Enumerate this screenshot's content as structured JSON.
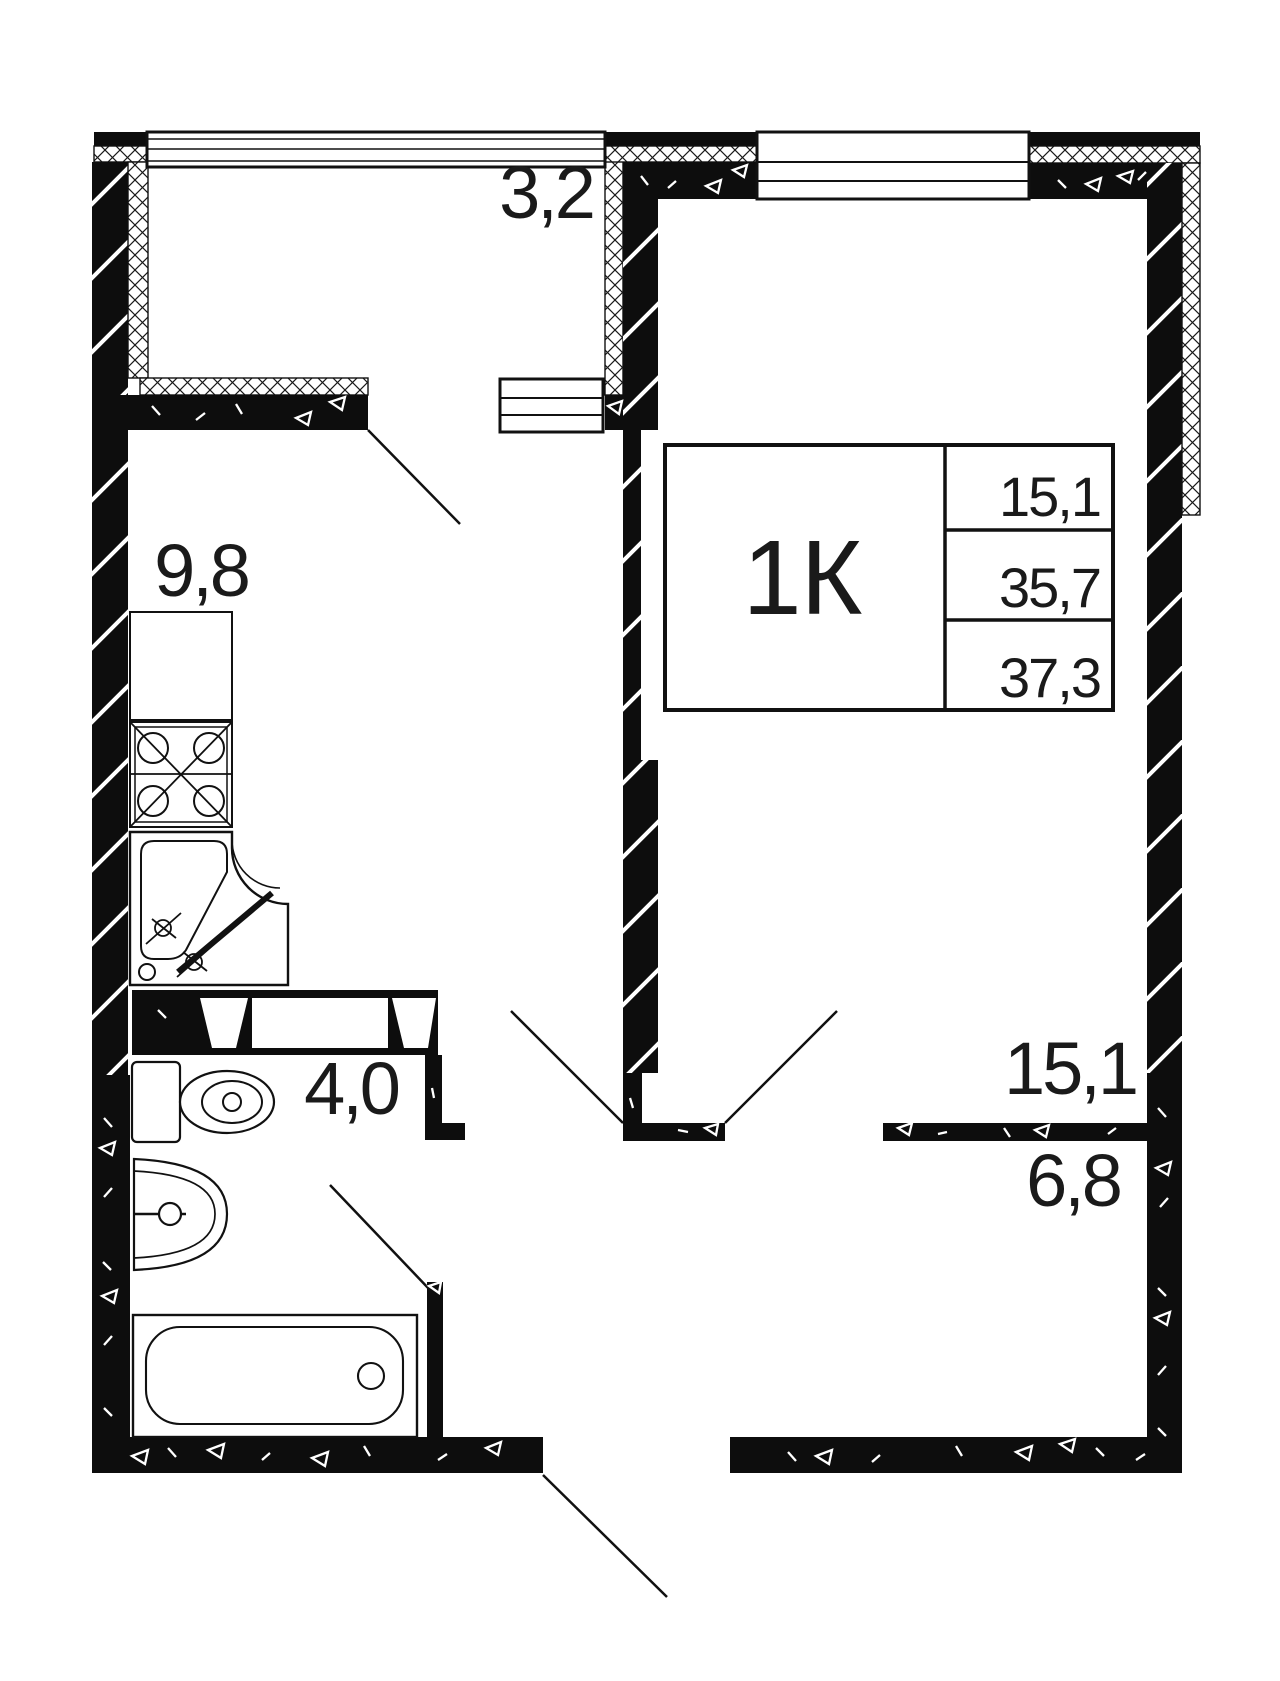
{
  "floor_plan": {
    "title_block": {
      "type_label": "1К",
      "living_area": "15,1",
      "total_area": "35,7",
      "total_area_with_balcony": "37,3"
    },
    "room_labels": {
      "balcony": "3,2",
      "kitchen": "9,8",
      "bathroom": "4,0",
      "living_room": "15,1",
      "hallway": "6,8"
    },
    "fixtures": [
      "kitchen-counter",
      "stove",
      "kitchen-sink",
      "toilet",
      "washbasin",
      "bathtub",
      "ventilation-shaft"
    ],
    "colors": {
      "wall": "#0d0d0d",
      "line": "#111111",
      "background": "#ffffff"
    }
  }
}
